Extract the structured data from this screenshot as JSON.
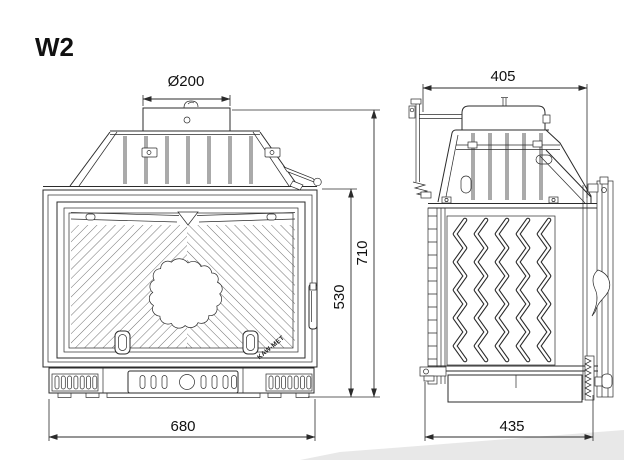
{
  "drawing": {
    "model": "W2",
    "brand": "KAW-MET"
  },
  "dimensions": {
    "flue_diameter": "Ø200",
    "top_depth": "405",
    "overall_height": "710",
    "door_height": "530",
    "overall_width": "680",
    "base_depth": "435"
  },
  "colors": {
    "line": "#2b2b2b",
    "background": "#ffffff",
    "text": "#111111"
  }
}
